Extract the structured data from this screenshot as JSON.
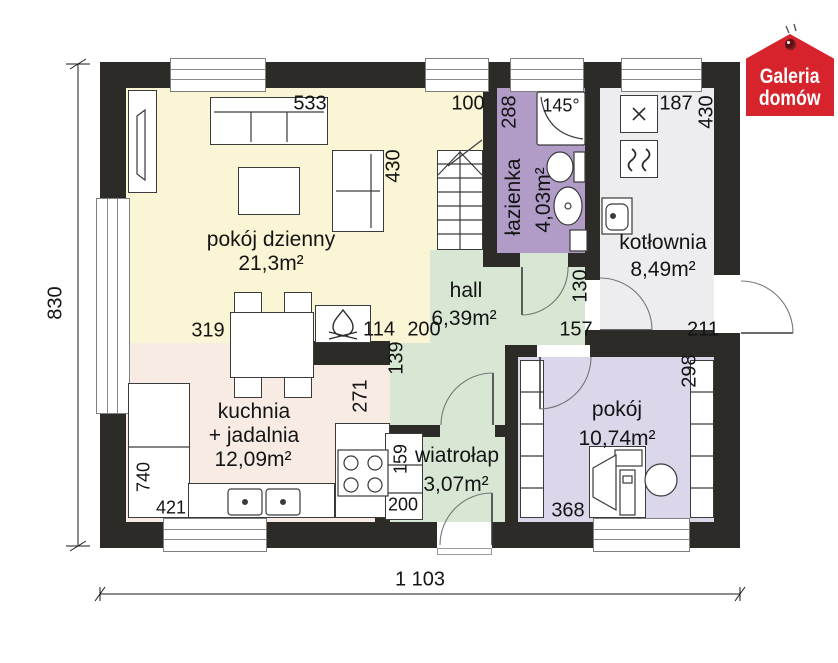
{
  "logo": {
    "line1": "Galeria",
    "line2": "domów",
    "color": "#d7242c"
  },
  "rooms": [
    {
      "id": "living",
      "name": "pokój dzienny",
      "area": "21,3m²",
      "color": "#faf5d5"
    },
    {
      "id": "kitchen",
      "name": "kuchnia",
      "name2": "+ jadalnia",
      "area": "12,09m²",
      "color": "#f7ebe4"
    },
    {
      "id": "hall",
      "name": "hall",
      "area": "6,39m²",
      "color": "#d7e7d4"
    },
    {
      "id": "bathroom",
      "name": "łazienka",
      "area": "4,03m²",
      "color": "#b19cc8"
    },
    {
      "id": "boiler",
      "name": "kotłownia",
      "area": "8,49m²",
      "color": "#ededef"
    },
    {
      "id": "room",
      "name": "pokój",
      "area": "10,74m²",
      "color": "#dcd6eb"
    },
    {
      "id": "vestibule",
      "name": "wiatrołap",
      "area": "3,07m²",
      "color": "#d7e7d4"
    }
  ],
  "dims": {
    "total_w": "1 103",
    "total_h": "830",
    "d533": "533",
    "d100": "100",
    "d288": "288",
    "d145": "145°",
    "d187": "187",
    "d430a": "430",
    "d430b": "430",
    "d319": "319",
    "d114": "114",
    "d200a": "200",
    "d139": "139",
    "d271": "271",
    "d130": "130",
    "d157": "157",
    "d211": "211",
    "d298": "298",
    "d368": "368",
    "d159": "159",
    "d200b": "200",
    "d740": "740",
    "d421": "421"
  },
  "colors": {
    "wall": "#2d2b28",
    "accent_red": "#d7242c"
  }
}
